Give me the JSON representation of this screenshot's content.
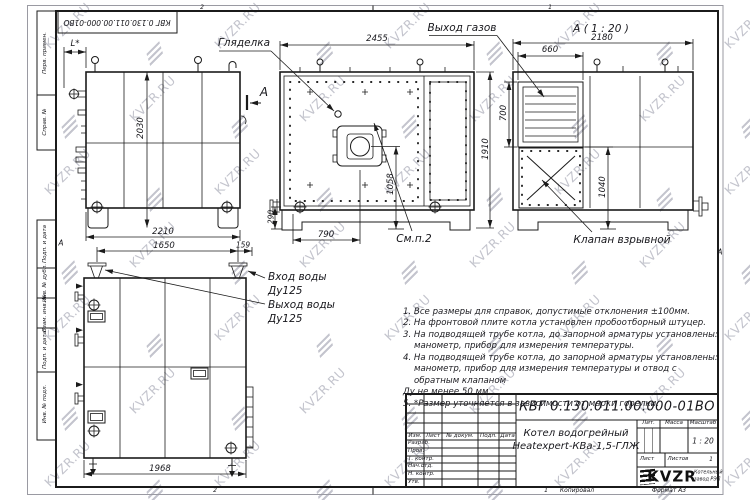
{
  "watermark": {
    "text": "KVZR.RU"
  },
  "corner_stamp": "КВГ 0.130.011.00.000-01ВО",
  "margin_labels": [
    "Перв. примен.",
    "Справ. №",
    "Подп. и дата",
    "Инв. № дубл.",
    "Взам. инв. №",
    "Подп. и дата",
    "Инв. № подл."
  ],
  "zones": {
    "top_2": "2",
    "top_1": "1",
    "bottom_2": "2",
    "bottom_1": "1",
    "left_a": "А",
    "right_a": "А"
  },
  "views": {
    "side": {
      "dim_height": "2030",
      "dim_width": "2210",
      "dim_l": "L*",
      "section_letter": "А"
    },
    "front": {
      "dim_width": "2455",
      "dim_height": "1910",
      "dim_burner_axis": "1058",
      "dim_burner_x": "790",
      "dim_pipe": "290",
      "label_peephole": "Гляделка",
      "label_flue": "Выход газов",
      "label_see": "См.п.2"
    },
    "section_a": {
      "caption": "А ( 1 : 20 )",
      "dim_width": "2180",
      "dim_flue_w": "660",
      "dim_flue_h": "700",
      "dim_valve": "1040",
      "label_valve": "Клапан взрывной"
    },
    "top": {
      "dim_span": "1650",
      "dim_offset": "159",
      "dim_length": "1968",
      "label_inlet": "Вход воды",
      "label_inlet_dn": "Ду125",
      "label_outlet": "Выход воды",
      "label_outlet_dn": "Ду125"
    }
  },
  "notes": [
    "1. Все размеры для справок, допустимые отклонения ±100мм.",
    "2. На фронтовой плите котла установлен пробоотборный штуцер.",
    "3. На подводящей трубе котла, до запорной арматуры установлены:",
    "манометр, прибор для измерения температуры.",
    "4. На подводящей трубе котла, до запорной арматуры установлены:",
    "манометр, прибор для измерения температуры и отвод с обратным клапаном",
    "Ду не менее 50 мм.",
    "5. *Размер уточняется в зависимости от марки горелки."
  ],
  "title_block": {
    "designation": "КВГ 0.130.011.00.000-01ВО",
    "name_line1": "Котел водогрейный",
    "name_line2": "Heatexpert-КВа-1,5-ГЛЖ",
    "cols": {
      "izm": "Изм.",
      "list": "Лист",
      "doc": "№ докум.",
      "podp": "Подп.",
      "data": "Дата"
    },
    "rows": [
      "Разраб.",
      "Пров.",
      "Т. контр.",
      "Нач.отд.",
      "Н. контр.",
      "Утв."
    ],
    "lit": "Лит.",
    "massa": "Масса",
    "masshtab": "Масштаб",
    "scale_value": "1 : 20",
    "list_label": "Лист",
    "listov_label": "Листов",
    "listov_value": "1",
    "logo_text": "KVZR",
    "company_line1": "Котельный",
    "company_line2": "завод РЭП",
    "kopiroval": "Копировал",
    "format": "Формат А3"
  }
}
